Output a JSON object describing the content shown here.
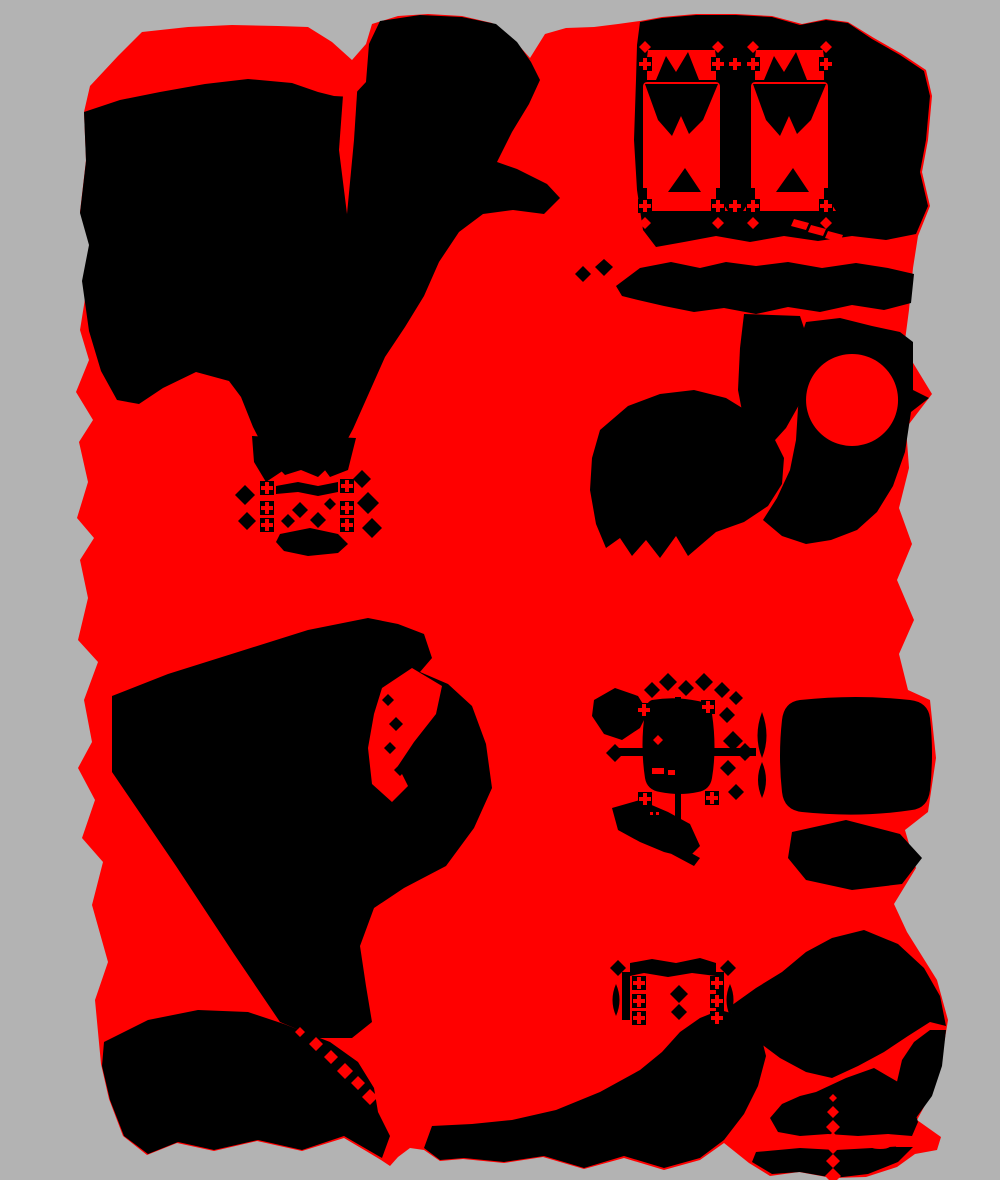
{
  "artwork": {
    "canvas": {
      "width": 1000,
      "height": 1180
    },
    "palette": {
      "background": "#b3b3b3",
      "primary": "#ff0000",
      "secondary": "#000000"
    },
    "shapes": [
      {
        "name": "base-red-mass",
        "fill": "primary",
        "path": "M90 86 L118 56 L142 32 L188 27 L232 25 L278 26 L308 27 L332 42 L352 60 L366 44 L372 24 L398 16 L428 14 L462 16 L492 23 L514 40 L530 58 L545 34 L566 28 L594 27 L618 24 L640 21 L662 17 L696 14 L736 14 L772 16 L802 24 L826 19 L848 22 L874 38 L902 54 L926 70 L932 96 L928 140 L922 172 L930 206 L918 236 L913 268 L909 310 L904 348 L932 394 L906 428 L909 468 L899 508 L912 544 L897 580 L914 620 L899 654 L908 690 L930 700 L936 758 L928 812 L905 830 L916 868 L894 904 L907 932 L937 980 L948 1020 L941 1062 L931 1094 L917 1120 L941 1137 L937 1150 L915 1154 L897 1167 L866 1177 L832 1178 L799 1172 L770 1176 L749 1163 L724 1143 L700 1160 L664 1170 L624 1158 L584 1169 L543 1157 L504 1163 L463 1159 L440 1161 L424 1150 L410 1148 L398 1157 L390 1166 L381 1160 L366 1151 L344 1138 L302 1151 L257 1141 L214 1151 L177 1143 L147 1155 L123 1136 L109 1099 L101 1064 L95 1000 L108 962 L92 905 L103 862 L82 838 L95 800 L78 768 L92 742 L84 700 L98 662 L78 640 L88 598 L80 560 L94 538 L77 518 L88 482 L79 442 L93 420 L76 392 L89 360 L80 330 L88 280 L94 240 L80 212 L86 160 L84 112 Z"
      },
      {
        "name": "blob-topleft-mass",
        "fill": "secondary",
        "path": "M84 112 L120 100 L160 92 L205 84 L248 79 L292 83 L318 92 L334 96 L352 97 L366 82 L369 44 L380 21 L420 15 L462 17 L496 24 L517 42 L531 62 L540 80 L529 104 L512 132 L497 162 L517 169 L547 184 L560 198 L544 214 L513 210 L483 214 L459 232 L439 262 L424 296 L405 327 L385 357 L369 393 L353 429 L337 459 L318 477 L301 470 L285 475 L269 458 L253 427 L241 397 L229 381 L196 372 L163 388 L139 404 L117 400 L101 371 L89 331 L82 281 L89 245 L80 213 L86 161 Z"
      },
      {
        "name": "topleft-red-tail",
        "fill": "primary",
        "path": "M290 30 L312 46 L334 66 L352 84 L346 96 L324 92 L302 70 L286 47 Z"
      },
      {
        "name": "topleft-red-sliver",
        "fill": "primary",
        "path": "M344 82 L358 78 L354 140 L347 214 L339 150 Z"
      },
      {
        "name": "blob-topright-mass",
        "fill": "secondary",
        "path": "M640 22 L662 18 L696 15 L736 15 L772 17 L800 25 L826 20 L848 23 L872 39 L900 55 L924 71 L930 96 L926 140 L920 172 L928 206 L916 234 L886 240 L852 236 L818 241 L784 236 L750 242 L716 236 L684 242 L656 247 L643 230 L637 190 L634 140 L636 80 L637 45 Z"
      },
      {
        "name": "card-left-banner",
        "fill": "primary",
        "path": "M648 50 H715 L719 80 H644 Z"
      },
      {
        "name": "card-right-banner",
        "fill": "primary",
        "path": "M756 50 H823 L827 80 H752 Z"
      },
      {
        "name": "card-left-banner-notch",
        "fill": "secondary",
        "path": "M656 80 L666 56 L676 72 L688 52 L699 80 Z"
      },
      {
        "name": "card-right-banner-notch",
        "fill": "secondary",
        "path": "M764 80 L774 56 L784 72 L796 52 L807 80 Z"
      },
      {
        "name": "card-left-panel",
        "fill": "primary",
        "path": "M647 82 H716 Q720 82 720 87 V188 Q720 193 716 193 H647 Q643 193 643 188 V87 Q643 82 647 82 Z"
      },
      {
        "name": "card-right-panel",
        "fill": "primary",
        "path": "M755 82 H824 Q828 82 828 87 V188 Q828 193 824 193 H755 Q751 193 751 188 V87 Q751 82 755 82 Z"
      },
      {
        "name": "card-left-hanging-v",
        "fill": "secondary",
        "path": "M645 84 H718 L703 120 L689 134 L681 116 L672 136 L658 120 Z"
      },
      {
        "name": "card-right-hanging-v",
        "fill": "secondary",
        "path": "M753 84 H826 L811 120 L797 134 L789 116 L780 136 L766 120 Z"
      },
      {
        "name": "card-left-bottom-wedge",
        "fill": "secondary",
        "path": "M668 192 L685 168 L701 192 Z"
      },
      {
        "name": "card-right-bottom-wedge",
        "fill": "secondary",
        "path": "M776 192 L793 168 L809 192 Z"
      },
      {
        "name": "card-left-pedestal",
        "fill": "primary",
        "path": "M647 193 H716 L728 211 H635 Z"
      },
      {
        "name": "card-right-pedestal",
        "fill": "primary",
        "path": "M755 193 H824 L836 211 H743 Z"
      },
      {
        "name": "card-finials-black",
        "fill": "secondary",
        "path": "M638 57h14v14h-14z M711 57h14v14h-14z M746 57h14v14h-14z M819 57h14v14h-14z M638 199h14v14h-14z M711 199h14v14h-14z M746 199h14v14h-14z M819 199h14v14h-14z M643 71h4v11h-4z M716 71h4v11h-4z M751 71h4v11h-4z M824 71h4v11h-4z M643 188h4v11h-4z M716 188h4v11h-4z M751 188h4v11h-4z M824 188h4v11h-4z"
      },
      {
        "name": "card-finials-red",
        "fill": "primary",
        "path": "M643 58h4v4h4v4h-4v4h-4v-4h-4v-4h4z M716 58h4v4h4v4h-4v4h-4v-4h-4v-4h4z M751 58h4v4h4v4h-4v4h-4v-4h-4v-4h4z M824 58h4v4h4v4h-4v4h-4v-4h-4v-4h4z M643 200h4v4h4v4h-4v4h-4v-4h-4v-4h4z M716 200h4v4h4v4h-4v4h-4v-4h-4v-4h4z M751 200h4v4h4v4h-4v4h-4v-4h-4v-4h4z M824 200h4v4h4v4h-4v4h-4v-4h-4v-4h4z M733 58h4v4h4v4h-4v4h-4v-4h-4v-4h4z M733 200h4v4h4v4h-4v4h-4v-4h-4v-4h4z M645 41l6 6l-6 6l-6 -6z M718 41l6 6l-6 6l-6 -6z M753 41l6 6l-6 6l-6 -6z M826 41l6 6l-6 6l-6 -6z M645 217l6 6l-6 6l-6 -6z M718 217l6 6l-6 6l-6 -6z M753 217l6 6l-6 6l-6 -6z M826 217l6 6l-6 6l-6 -6z"
      },
      {
        "name": "topright-red-dashes",
        "fill": "primary",
        "path": "M794 219l15 4l-3 7l-15 -4z M811 225l15 4l-3 7l-15 -4z M828 231l15 4l-3 7l-15 -4z"
      },
      {
        "name": "right-band",
        "fill": "secondary",
        "path": "M616 286 L640 268 L671 262 L700 268 L726 262 L756 266 L788 262 L822 268 L856 263 L888 268 L914 274 L911 303 L884 310 L852 305 L820 312 L788 307 L756 314 L724 308 L694 312 L664 306 L638 300 L622 296 Z"
      },
      {
        "name": "right-band-bits",
        "fill": "secondary",
        "path": "M583 266l8 8l-8 8l-8 -8z M604 259l9 8l-9 9l-9 -9z"
      },
      {
        "name": "right-stem",
        "fill": "secondary",
        "path": "M744 314 L800 316 L812 352 L804 396 L786 428 L766 450 L746 432 L738 390 L740 348 Z"
      },
      {
        "name": "right-mid-mass",
        "fill": "secondary",
        "path": "M806 322 L840 318 L872 326 L900 332 L913 342 L913 390 L929 398 L911 412 L905 452 L893 486 L877 512 L857 530 L831 540 L806 544 L782 536 L763 520 L777 498 L790 470 L796 440 L798 408 L802 370 L800 340 Z"
      },
      {
        "name": "right-red-circle",
        "fill": "primary",
        "path": "M852 354a46 46 0 1 0 0.1 0z"
      },
      {
        "name": "mid-lower-mass",
        "fill": "secondary",
        "path": "M600 430 L628 406 L660 394 L694 390 L726 398 L752 414 L772 434 L784 458 L782 484 L768 506 L744 522 L716 532 L688 556 L676 536 L660 558 L646 540 L632 556 L620 538 L606 548 L596 524 L590 490 L592 458 Z"
      },
      {
        "name": "cluster1-triangles",
        "fill": "secondary",
        "path": "M252 436 L292 438 L284 470 L266 482 L254 462 Z M312 436 L356 438 L348 470 L330 477 L316 458 Z"
      },
      {
        "name": "cluster1-diamonds",
        "fill": "secondary",
        "path": "M245 485l10 10l-10 10l-10 -10z M247 512l9 9l-9 9l-9 -9z M362 470l9 9l-9 9l-9 -9z M368 492l11 11l-11 11l-11 -11z M372 518l10 10l-10 10l-10 -10z"
      },
      {
        "name": "cluster1-bar",
        "fill": "secondary",
        "path": "M276 486 L298 482 L318 486 L338 482 L338 492 L318 496 L298 492 L276 494 Z"
      },
      {
        "name": "cluster1-center-diamonds",
        "fill": "secondary",
        "path": "M300 502l8 8l-8 8l-8 -8z M318 512l8 8l-8 8l-8 -8z M288 514l7 7l-7 7l-7 -7z M330 498l6 6l-6 6l-6 -6z"
      },
      {
        "name": "cluster1-bottom-blob",
        "fill": "secondary",
        "path": "M280 534 L310 528 L338 534 L348 544 L338 553 L308 556 L284 551 L276 542 Z"
      },
      {
        "name": "cluster1-squares-black",
        "fill": "secondary",
        "path": "M260 481h14v14h-14z M260 501h14v14h-14z M260 518h14v14h-14z M340 479h14v14h-14z M340 501h14v14h-14z M340 518h14v14h-14z"
      },
      {
        "name": "cluster1-squares-red",
        "fill": "primary",
        "path": "M265 482h4v4h4v4h-4v4h-4v-4h-4v-4h4z M265 502h4v4h4v4h-4v4h-4v-4h-4v-4h4z M265 519h4v4h4v4h-4v4h-4v-4h-4v-4h4z M345 480h4v4h4v4h-4v4h-4v-4h-4v-4h4z M345 502h4v4h4v4h-4v4h-4v-4h-4v-4h4z M345 519h4v4h4v4h-4v4h-4v-4h-4v-4h4z"
      },
      {
        "name": "blob-bottomleft-mass",
        "fill": "secondary",
        "path": "M112 696 L168 674 L238 652 L308 630 L368 618 L398 624 L424 634 L432 658 L420 672 L448 684 L472 706 L486 744 L492 788 L474 828 L446 866 L404 888 L374 908 L360 946 L366 986 L372 1022 L352 1038 L318 1038 L280 1022 L234 954 L176 866 L112 772 Z"
      },
      {
        "name": "bottomleft-red-gap",
        "fill": "primary",
        "path": "M382 688 L412 668 L442 686 L436 714 L414 742 L398 766 L408 786 L392 802 L372 784 L368 748 L374 714 Z"
      },
      {
        "name": "bottomleft-gap-diamonds",
        "fill": "secondary",
        "path": "M388 694l6 6l-6 6l-6 -6z M396 717l7 7l-7 7l-7 -7z M390 742l6 6l-6 6l-6 -6z M400 764l6 6l-6 6l-6 -6z"
      },
      {
        "name": "bottomleft-neck-red-bits",
        "fill": "primary",
        "path": "M374 930l5 6l-5 6l-5 -6z M370 950l5 6l-5 6l-5 -6z M376 970l5 6l-5 6l-5 -6z"
      },
      {
        "name": "bottom-left-lower-mass",
        "fill": "secondary",
        "path": "M104 1042 L148 1020 L198 1010 L248 1012 L284 1024 L330 1042 L358 1062 L374 1088 L378 1112 L390 1136 L382 1158 L344 1136 L302 1150 L258 1140 L214 1150 L178 1142 L148 1154 L124 1136 L110 1100 L102 1066 Z"
      },
      {
        "name": "bottom-red-diamond-chain",
        "fill": "primary",
        "path": "M316 1037l7 7l-7 7l-7 -7z M331 1050l7 7l-7 7l-7 -7z M345 1063l8 8l-8 8l-8 -8z M358 1076l7 7l-7 7l-7 -7z M370 1089l8 8l-8 8l-8 -8z M300 1027l5 5l-5 5l-5 -5z"
      },
      {
        "name": "bottom-center-pyramid",
        "fill": "secondary",
        "path": "M424 1148 L432 1126 L472 1124 L512 1120 L556 1110 L600 1092 L640 1070 L662 1052 L680 1032 L700 1018 L720 1010 L742 1016 L760 1032 L766 1056 L758 1086 L744 1114 L724 1140 L700 1158 L664 1168 L624 1156 L584 1168 L544 1156 L504 1162 L464 1158 L440 1160 Z"
      },
      {
        "name": "bottomright-upper-mass",
        "fill": "secondary",
        "path": "M728 1008 L756 988 L782 972 L806 952 L832 938 L864 930 L898 944 L924 968 L940 996 L946 1026 L930 1022 L908 1036 L884 1052 L858 1066 L832 1078 L806 1072 L780 1058 L756 1040 L738 1024 Z"
      },
      {
        "name": "bottomright-right-wedge",
        "fill": "secondary",
        "path": "M946 1030 L942 1066 L932 1096 L916 1118 L902 1108 L896 1086 L902 1060 L914 1042 L930 1030 Z"
      },
      {
        "name": "bottomright-lower-mass",
        "fill": "secondary",
        "path": "M816 1092 L846 1078 L874 1068 L898 1082 L912 1102 L918 1122 L912 1136 L888 1134 L858 1136 L828 1134 L800 1136 L778 1132 L770 1118 L782 1104 L800 1096 Z"
      },
      {
        "name": "bottomright-below-band",
        "fill": "secondary",
        "path": "M756 1152 L800 1148 L836 1150 L872 1148 L906 1146 L916 1144 L898 1162 L868 1174 L834 1178 L800 1172 L772 1174 L752 1162 Z"
      },
      {
        "name": "bottomright-red-crosshair",
        "fill": "primary",
        "path": "M766 1139h50l4 9h-52z M898 1138h40l-2 9h-40z M833 1132l11 11l-11 11l-11 -11z M852 1137l6 6l-6 6l-6 -6z M864 1139l4 4l-4 4l-4 -4z M880 1137q12 0 12 6t-12 6q-12 0 -12 -6t12 -6z M833 1106l6 6l-6 6l-6 -6z M833 1120l7 7l-7 7l-7 -7z M833 1154l7 7l-7 7l-7 -7z M833 1168l8 8l-8 8l-8 -8z M833 1094l4 4l-4 4l-4 -4z"
      },
      {
        "name": "cluster2-left-wing",
        "fill": "secondary",
        "path": "M594 700 L615 688 L638 696 L648 712 L640 728 L622 740 L604 734 L592 716 Z"
      },
      {
        "name": "cluster2-top-diamonds",
        "fill": "secondary",
        "path": "M652 682l8 8l-8 8l-8 -8z M668 673l9 9l-9 9l-9 -9z M686 680l8 8l-8 8l-8 -8z M704 673l9 9l-9 9l-9 -9z M722 682l8 8l-8 8l-8 -8z M736 691l7 7l-7 7l-7 -7z"
      },
      {
        "name": "cluster2-center-blob",
        "fill": "secondary",
        "path": "M652 700 Q646 702 645 712 Q640 745 645 778 Q647 790 660 792 Q680 796 698 792 Q710 790 712 778 Q717 748 712 714 Q710 703 698 701 Q675 696 652 700 Z"
      },
      {
        "name": "cluster2-blob-red-marks",
        "fill": "primary",
        "path": "M652 768h12v6h-12z M668 770h10v5h-10z M658 735l5 5l-5 5l-5 -5z"
      },
      {
        "name": "cluster2-axis-vertical",
        "fill": "secondary",
        "path": "M675 697h6v138h-6z M677 719l9 9l-9 9l-9 -9z M677 748l11 11l-11 11l-11 -11z"
      },
      {
        "name": "cluster2-axis-horizontal",
        "fill": "secondary",
        "path": "M616 748h140v8h-140z M615 744l9 9l-9 9l-9 -9z M745 743l9 9l-9 9l-9 -9z"
      },
      {
        "name": "cluster2-right-wing",
        "fill": "secondary",
        "path": "M727 707l8 8l-8 8l-8 -8z M733 731l10 10l-10 10l-10 -10z M728 760l8 8l-8 8l-8 -8z M736 784l8 8l-8 8l-8 -8z M762 712q9 24 0 46q-9 -22 0 -46z M762 762q8 18 0 36q-8 -18 0 -36z"
      },
      {
        "name": "cluster2-bottom-wing",
        "fill": "secondary",
        "path": "M612 808 L640 800 L668 812 L690 824 L700 846 L688 858 L664 852 L640 842 L618 830 Z M668 840 L700 858 L694 866 L664 850 Z"
      },
      {
        "name": "cluster2-marks-black",
        "fill": "secondary",
        "path": "M637 703h14v14h-14z M701 700h14v14h-14z M638 792h14v14h-14z M705 791h14v14h-14z"
      },
      {
        "name": "cluster2-marks-red",
        "fill": "primary",
        "path": "M642 704h4v4h4v4h-4v4h-4v-4h-4v-4h4z M706 701h4v4h4v4h-4v4h-4v-4h-4v-4h4z M643 793h4v4h4v4h-4v4h-4v-4h-4v-4h4z M710 792h4v4h4v4h-4v4h-4v-4h-4v-4h4z M650 812h3v3h-3z M656 812h3v3h-3z"
      },
      {
        "name": "cluster2-right-mass",
        "fill": "secondary",
        "path": "M800 700 Q784 702 782 720 Q778 756 782 792 Q784 810 802 812 Q860 818 912 810 Q928 808 930 790 Q934 754 930 718 Q928 702 910 700 Q856 694 800 700 Z"
      },
      {
        "name": "cluster2-lower-wing",
        "fill": "secondary",
        "path": "M792 832 L846 820 L900 834 L922 858 L902 884 L852 890 L806 880 L788 858 Z"
      },
      {
        "name": "frame-bottom-black",
        "fill": "secondary",
        "path": "M630 963 L652 959 L676 963 L700 958 L716 963 L716 976 L692 973 L668 977 L644 973 L630 976 Z M622 972h8v48h-8z M716 972h8v48h-8z M618 960l8 8l-8 8l-8 -8z M728 960l8 8l-8 8l-8 -8z M616 984q7 16 0 32q-7 -16 0 -32z M730 984q7 16 0 32q-7 -16 0 -32z M679 985l9 9l-9 9l-9 -9z M679 1004l8 8l-8 8l-8 -8z"
      },
      {
        "name": "frame-bottom-marks-black",
        "fill": "secondary",
        "path": "M632 976h14v14h-14z M632 994h14v14h-14z M632 1011h14v14h-14z M710 976h14v14h-14z M710 994h14v14h-14z M710 1011h14v14h-14z"
      },
      {
        "name": "frame-bottom-marks-red",
        "fill": "primary",
        "path": "M637 977h4v4h4v4h-4v4h-4v-4h-4v-4h4z M637 995h4v4h4v4h-4v4h-4v-4h-4v-4h4z M637 1012h4v4h4v4h-4v4h-4v-4h-4v-4h4z M715 977h4v4h4v4h-4v4h-4v-4h-4v-4h4z M715 995h4v4h4v4h-4v4h-4v-4h-4v-4h4z M715 1012h4v4h4v4h-4v4h-4v-4h-4v-4h4z"
      }
    ]
  }
}
